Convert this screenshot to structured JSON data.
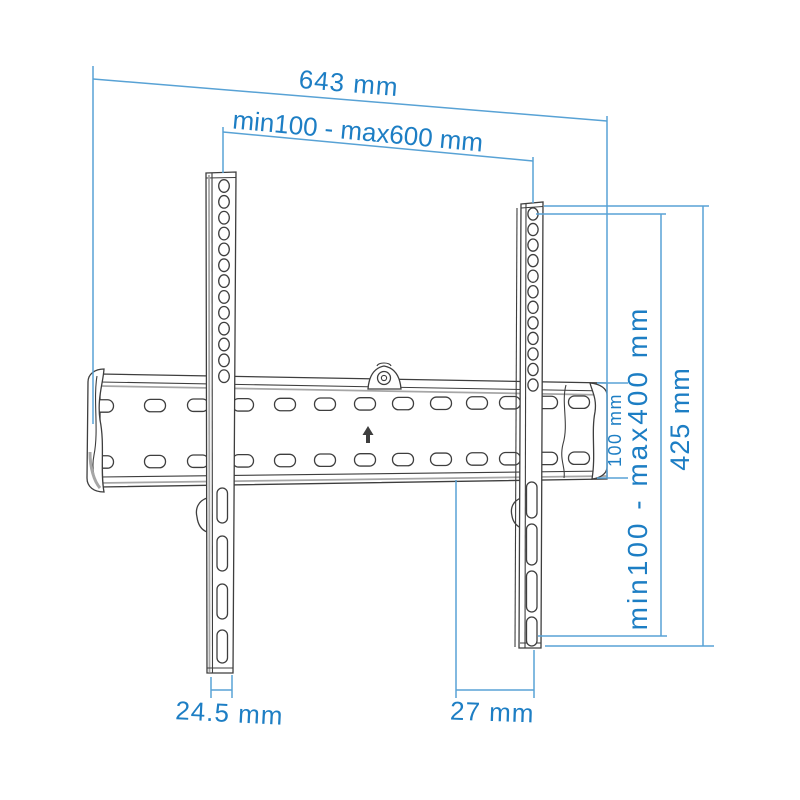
{
  "page": {
    "background_color": "#ffffff"
  },
  "diagram": {
    "subject": "TV wall mount bracket dimension drawing",
    "accent_color": "#1d7ec4",
    "dimension_line_color": "#58a2d5",
    "drawing_line_color": "#3e3e3e",
    "labels": {
      "total_width": "643 mm",
      "vesa_width_range": "min100 - max600 mm",
      "overall_height": "425 mm",
      "vesa_height_range": "min100 - max400 mm",
      "rail_height": "100 mm",
      "arm_width": "24.5 mm",
      "arm_to_rail_end": "27 mm"
    }
  }
}
